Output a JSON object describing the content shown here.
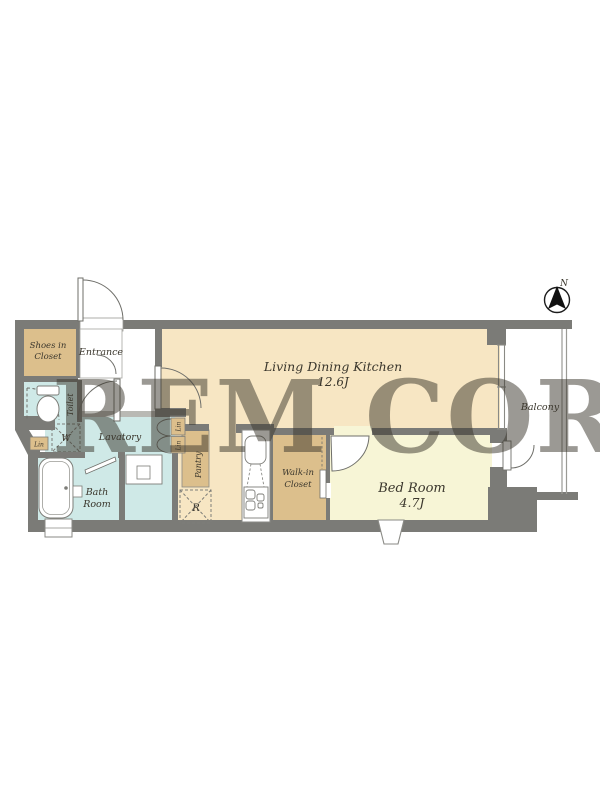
{
  "watermark": "REM CORP",
  "compass": {
    "north_label": "N"
  },
  "rooms": {
    "ldk": {
      "name": "Living Dining Kitchen",
      "size": "12.6J"
    },
    "bedroom": {
      "name": "Bed Room",
      "size": "4.7J"
    },
    "balcony": {
      "name": "Balcony"
    },
    "entrance": {
      "name": "Entrance"
    },
    "shoes_in_closet": {
      "line1": "Shoes in",
      "line2": "Closet"
    },
    "toilet": {
      "name": "Toilet"
    },
    "lavatory": {
      "name": "Lavatory"
    },
    "bathroom": {
      "line1": "Bath",
      "line2": "Room"
    },
    "pantry": {
      "name": "Pantry"
    },
    "walk_in_closet": {
      "line1": "Walk-in",
      "line2": "Closet"
    }
  },
  "fixtures": {
    "washer": "W",
    "refrigerator": "R",
    "linen_left": "Lin",
    "linen_upper": "Lin",
    "linen_lower": "Lin"
  },
  "colors": {
    "wall": "#7b7b77",
    "ldk_floor": "#f7e6c3",
    "bedroom_floor": "#f7f5d6",
    "closet_tan": "#dcbf8c",
    "wet_area_blue": "#cfe9e7",
    "balcony_white": "#ffffff",
    "watermark_white": "#ffffff"
  }
}
